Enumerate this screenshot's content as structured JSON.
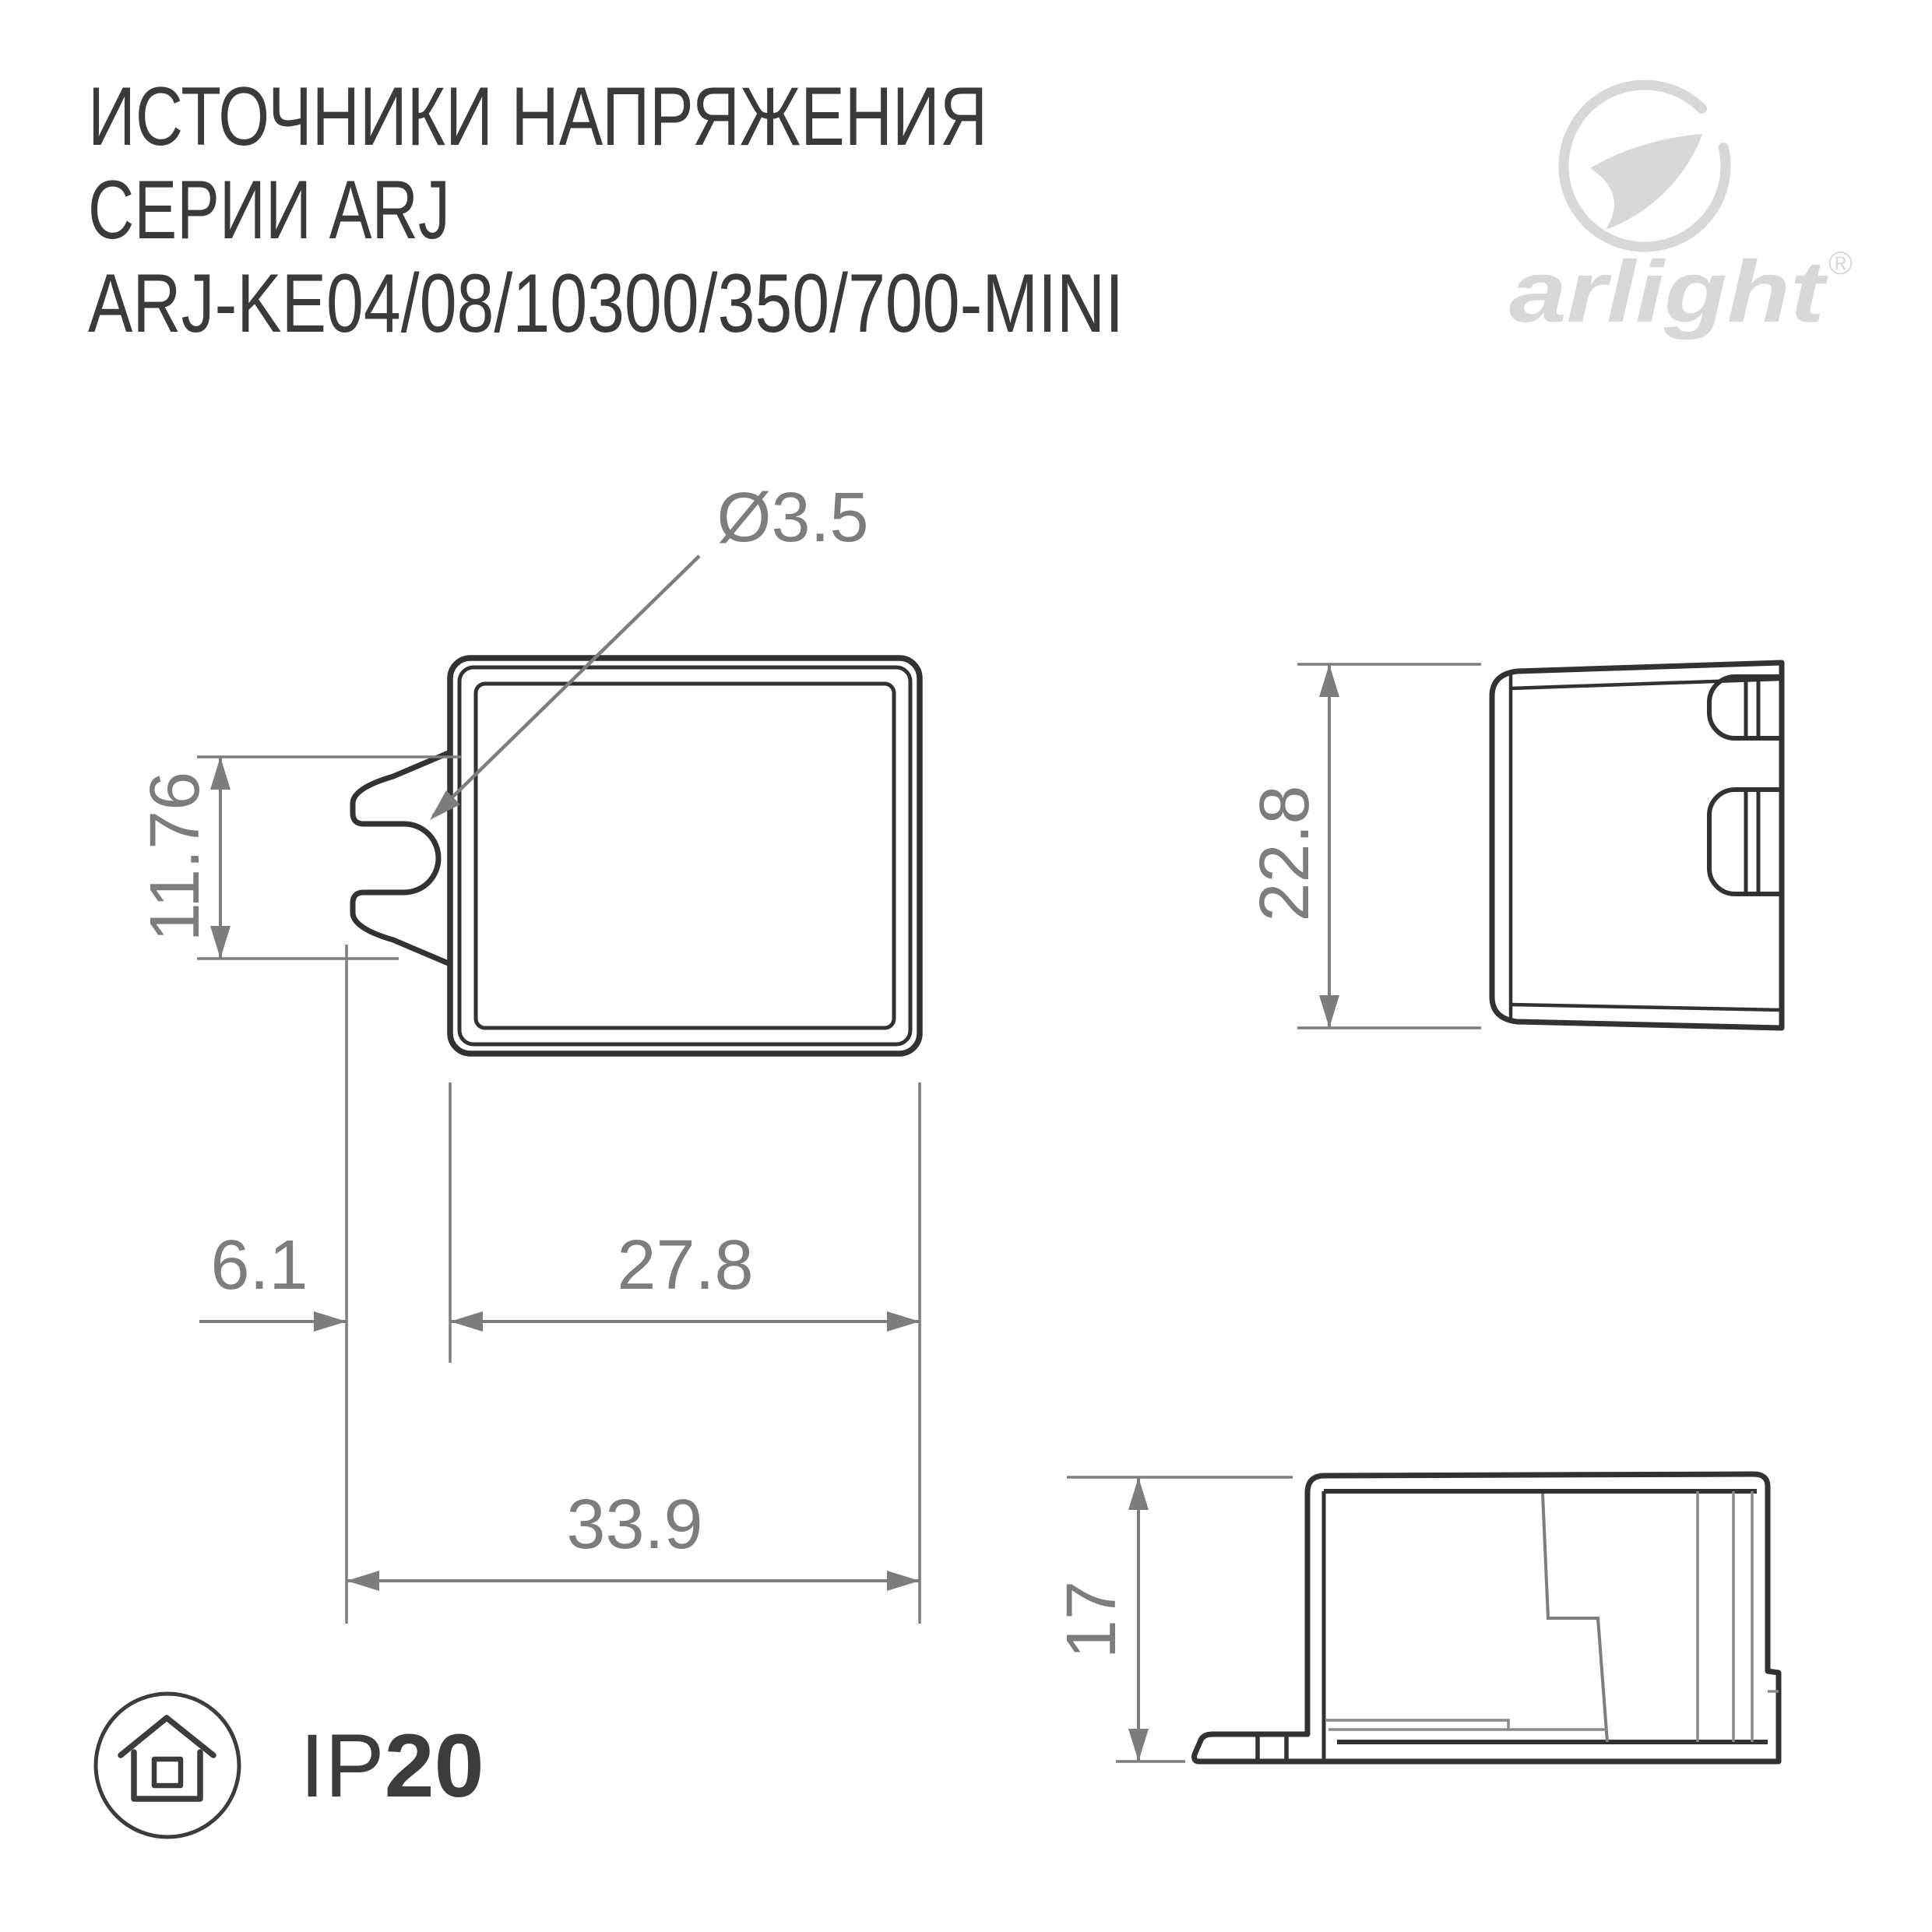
{
  "page": {
    "background": "#ffffff"
  },
  "title": {
    "line1": "ИСТОЧНИКИ НАПРЯЖЕНИЯ",
    "line2": "СЕРИИ ARJ",
    "line3": "ARJ-KE04/08/10300/350/700-MINI"
  },
  "logo": {
    "brand": "arlight",
    "registered": "®",
    "color": "#d8d8d8"
  },
  "ip_rating": {
    "prefix": "IP",
    "value": "20"
  },
  "drawing": {
    "line_color": "#323232",
    "dim_color": "#7d7d7d",
    "front_view": {
      "dims": {
        "hole_diameter": "Ø3.5",
        "slot_height": "11.76",
        "tab_offset": "6.1",
        "body_width": "27.8",
        "overall_width": "33.9"
      }
    },
    "side_view": {
      "dims": {
        "height": "22.8"
      }
    },
    "profile_view": {
      "dims": {
        "depth": "17"
      }
    }
  }
}
